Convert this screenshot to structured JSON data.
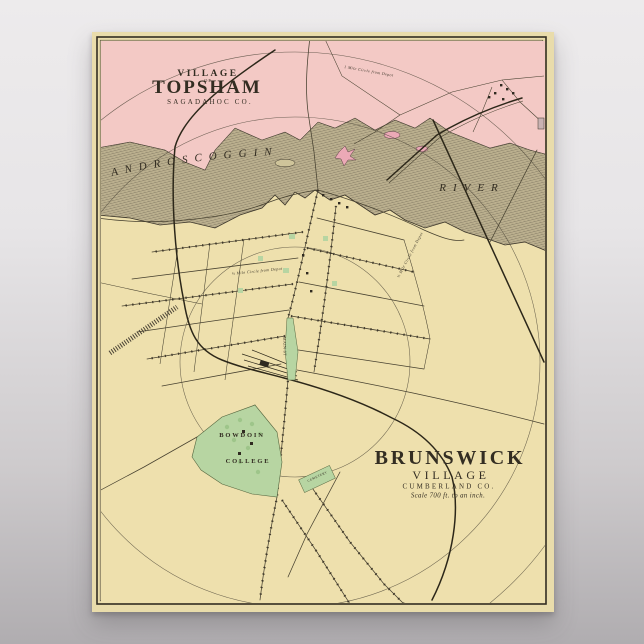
{
  "background": {
    "gray_top": "#edebec",
    "gray_bottom": "#b0adb0"
  },
  "poster": {
    "colors": {
      "paper": "#e9dcab",
      "land": "#eee0ad",
      "topsham_pink": "#f3c9c5",
      "river_base": "#d5c9a2",
      "hatch_ink": "#6a6150",
      "green": "#b7d5a2",
      "tree_green": "#9cc488",
      "ink": "#332d22",
      "island_pink": "#eba9b6"
    },
    "topsham_title": {
      "village": "VILLAGE",
      "of": "OF",
      "name": "TOPSHAM",
      "county": "SAGADAHOC CO."
    },
    "river_labels": {
      "androscoggin": "ANDROSCOGGIN",
      "river": "RIVER"
    },
    "brunswick_title": {
      "name": "BRUNSWICK",
      "village": "VILLAGE",
      "county": "CUMBERLAND CO.",
      "scale": "Scale 700 ft. to an inch."
    },
    "college": {
      "line1": "BOWDOIN",
      "line2": "COLLEGE"
    },
    "map_labels": {
      "main_street": "MAIN ST",
      "cemetery": "CEMETERY",
      "half_mile_circle": "½ Mile Circle from Depot",
      "one_mile_circle": "1 Mile Circle from Depot"
    }
  }
}
